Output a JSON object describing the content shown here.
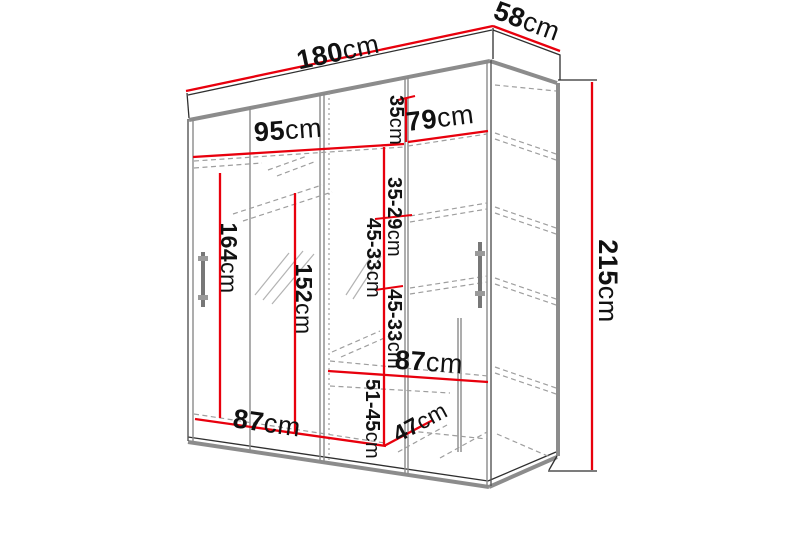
{
  "diagram": {
    "type": "furniture-dimension-diagram",
    "subject": "sliding-door wardrobe with mirror",
    "unit": "cm",
    "colors": {
      "dimension_line": "#e8000d",
      "outline": "#2f2f2f",
      "edge_gray": "#8c8c8c",
      "dashed_gray": "#9e9e9e",
      "text": "#111111",
      "background": "#ffffff"
    },
    "dimensions": {
      "total_width": {
        "value": "180",
        "unit": "cm"
      },
      "total_depth": {
        "value": "58",
        "unit": "cm"
      },
      "total_height": {
        "value": "215",
        "unit": "cm"
      },
      "left_interior_width": {
        "value": "95",
        "unit": "cm"
      },
      "right_interior_width": {
        "value": "79",
        "unit": "cm"
      },
      "top_shelf_height": {
        "value": "35",
        "unit": "cm"
      },
      "shelf_gap_upper": {
        "value": "35-29",
        "unit": "cm"
      },
      "shelf_gap_middle_1": {
        "value": "45-33",
        "unit": "cm"
      },
      "shelf_gap_middle_2": {
        "value": "45-33",
        "unit": "cm"
      },
      "shelf_gap_lower": {
        "value": "51-45",
        "unit": "cm"
      },
      "hanging_section_height": {
        "value": "164",
        "unit": "cm"
      },
      "mirror_section_height": {
        "value": "152",
        "unit": "cm"
      },
      "bottom_left_width": {
        "value": "87",
        "unit": "cm"
      },
      "middle_shelf_width": {
        "value": "87",
        "unit": "cm"
      },
      "interior_depth": {
        "value": "47",
        "unit": "cm"
      }
    }
  }
}
